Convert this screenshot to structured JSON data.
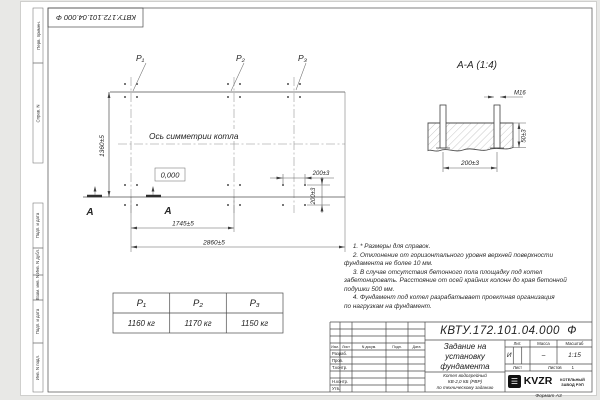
{
  "stamp_top": "КВТУ.172.101.04.000  Ф",
  "format_label": "Формат А3",
  "margin_labels": {
    "perv_primen": "Перв. примен.",
    "sprav_n": "Справ. N",
    "podp_data_1": "Подп. и дата",
    "inv_dubl": "Инв. N дубл.",
    "vzam_inv": "Взам. инв. N",
    "podp_data_2": "Подп. и дата",
    "inv_podl": "Инв. N подл."
  },
  "plan": {
    "p1": "P₁",
    "p2": "P₂",
    "p3": "P₃",
    "axis_text": "Ось симметрии котла",
    "level": "0,000",
    "dim_height": "1360±5",
    "dim_col": "1745±5",
    "dim_total": "2860±5",
    "dim_bolt_x": "200±3",
    "dim_bolt_y": "200±3",
    "section_letter": "А"
  },
  "section": {
    "title": "А-А (1:4)",
    "thread": "М16",
    "dim_width": "200±3",
    "dim_depth": "50±3"
  },
  "notes": [
    "     1. * Размеры для справок.",
    "     2. Отклонение от горизонтального уровня верхней поверхности",
    "фундамента не более 10 мм.",
    "     3. В случае отсутствия бетонного пола площадку под котел",
    "забетонировать. Расстояние от осей крайних колонн до края бетонной",
    "подушки 500 мм.",
    "     4. Фундамент под котел разрабатывает проектная организация",
    "по нагрузкам на фундамент."
  ],
  "load_table": {
    "headers": [
      "P₁",
      "P₂",
      "P₃"
    ],
    "values": [
      "1160 кг",
      "1170 кг",
      "1150 кг"
    ]
  },
  "title_block": {
    "designation": "КВТУ.172.101.04.000  Ф",
    "cols": [
      "Изм.",
      "Лист",
      "N докум.",
      "Подп.",
      "Дата"
    ],
    "rows": [
      "Разраб.",
      "Пров.",
      "Т.контр.",
      "Н.контр.",
      "Утв."
    ],
    "title_lines": [
      "Задание на",
      "установку",
      "фундамента"
    ],
    "product_lines": [
      "Котел водогрейный",
      "КВ-2,0 КБ (РВР)",
      "по техническому заданию"
    ],
    "lit_header": "Лит.",
    "mass_header": "Масса",
    "scale_header": "Масштаб",
    "lit": "И",
    "mass": "–",
    "scale": "1:15",
    "sheet_label": "Лист",
    "sheets_label": "Листов",
    "sheets_value": "1",
    "logo_glyph": "☰",
    "logo_text": "KVZR",
    "company_lines": [
      "КОТЕЛЬНЫЙ",
      "ЗАВОД РЭП"
    ]
  },
  "colors": {
    "line": "#4f4f4f",
    "sheet": "#ffffff",
    "background": "#e8e8e6",
    "logo": "#111111"
  }
}
